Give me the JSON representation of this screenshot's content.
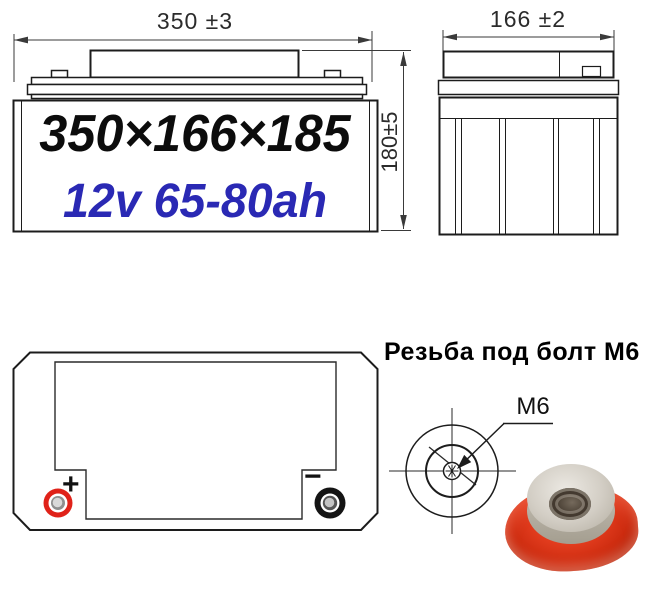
{
  "front_view": {
    "width_dim": "350 ±3",
    "height_dim": "180±5",
    "size_label": "350×166×185",
    "capacity_label": "12v 65-80ah"
  },
  "side_view": {
    "width_dim": "166 ±2"
  },
  "top_view": {
    "positive_sign": "+",
    "negative_sign": "−"
  },
  "thread_detail": {
    "title": "Резьба под болт М6",
    "thread_label": "M6"
  },
  "colors": {
    "line": "#1c1c1c",
    "dim_line": "#3a3a3a",
    "capacity_blue": "#2a29b4",
    "positive_red": "#e02219",
    "negative_black": "#141414",
    "nut_red": "#e23c1e",
    "nut_metal": "#d3cec5"
  }
}
